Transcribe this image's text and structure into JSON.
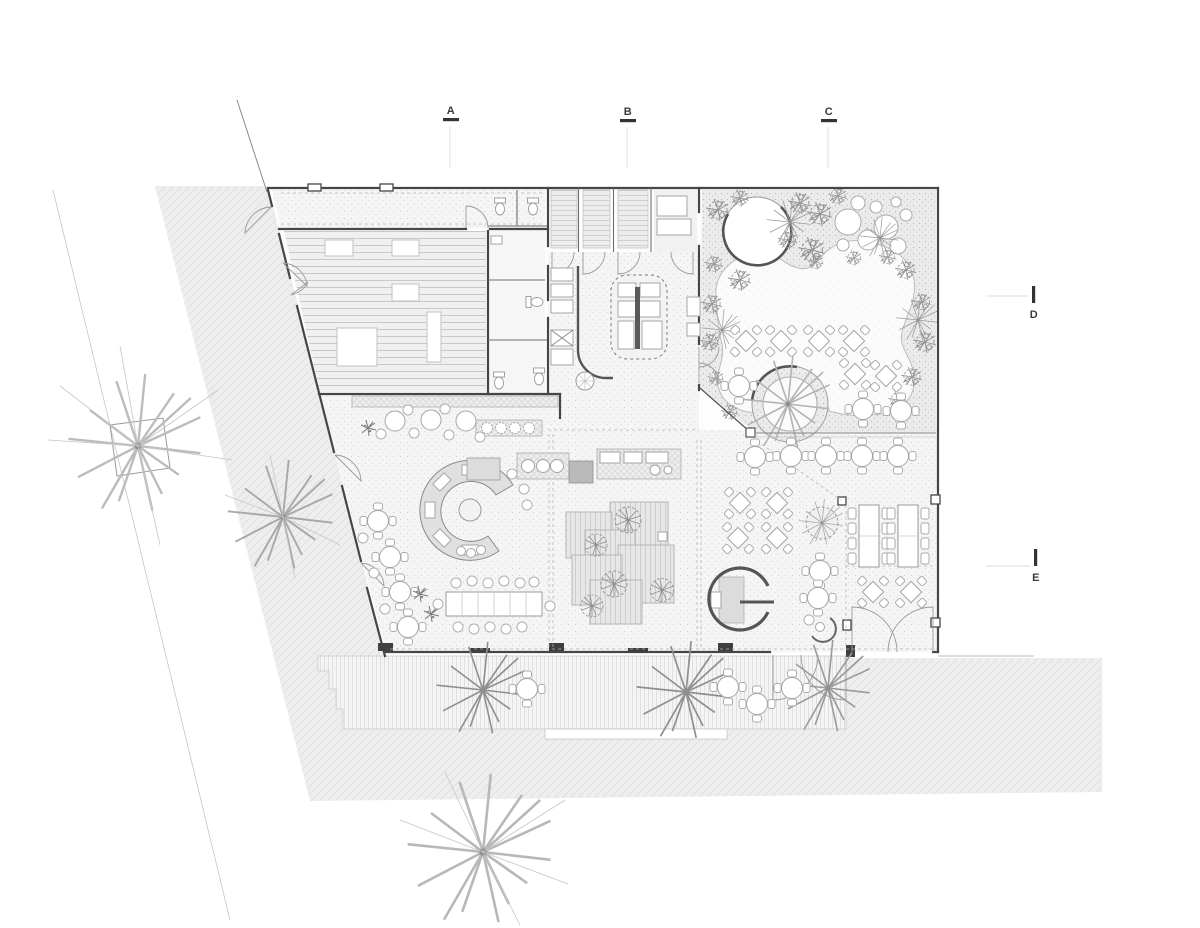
{
  "section_markers": {
    "top": [
      {
        "id": "A",
        "label": "A"
      },
      {
        "id": "B",
        "label": "B"
      },
      {
        "id": "C",
        "label": "C"
      }
    ],
    "right": [
      {
        "id": "D",
        "label": "D"
      },
      {
        "id": "E",
        "label": "E"
      }
    ]
  },
  "colors": {
    "background": "#ffffff",
    "wall": "#464646",
    "medium_line": "#8c8c8c",
    "light_line": "#c6c6c6",
    "paving_fill": "#eeeeee",
    "terrace_fill": "#f6f6f6",
    "deck_fill": "#e7e7e7",
    "foliage": "#8f8f8f",
    "marker_text": "#3a3a3a"
  },
  "icons": [
    "star-tree-icon",
    "square-planter-tree-icon",
    "foliage-clump-icon",
    "canopy-circles-icon",
    "round-table-icon",
    "diamond-table-icon",
    "long-table-icon",
    "stool-icon",
    "toilet-icon",
    "door-swing-icon",
    "circular-bar-icon",
    "kitchen-island-icon",
    "planter-ring-icon",
    "spiral-booth-icon",
    "deck-platform-icon",
    "display-counter-icon"
  ]
}
